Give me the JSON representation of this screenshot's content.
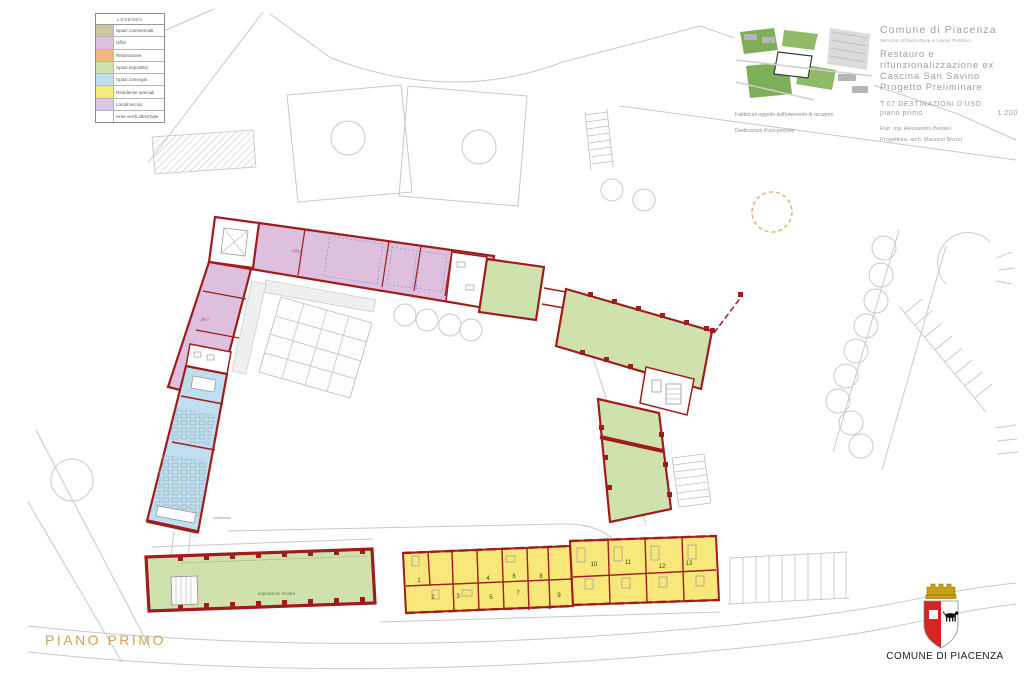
{
  "legend": {
    "title": "LEGENDA",
    "items": [
      {
        "label": "Spazi commerciali",
        "color": "#cdc6a0"
      },
      {
        "label": "Uffici",
        "color": "#dcc0dc"
      },
      {
        "label": "Ristorazione",
        "color": "#f3b579"
      },
      {
        "label": "Spazi espositivi",
        "color": "#cfe2ae"
      },
      {
        "label": "Spazi convegni",
        "color": "#bfdff0"
      },
      {
        "label": "Residenze speciali",
        "color": "#f8e97d"
      },
      {
        "label": "Locali tecnici",
        "color": "#d8c9e8"
      },
      {
        "label": "Aree verdi attrezzate",
        "color": "#ffffff"
      }
    ]
  },
  "title_block": {
    "municipality": "Comune di Piacenza",
    "department": "Servizio Infrastrutture e Lavori Pubblici",
    "project_lines": [
      "Restauro e",
      "rifunzionalizzazione ex",
      "Cascina San Savino",
      "Progetto Preliminare"
    ],
    "sheet_code": "T.07",
    "sheet_name": "DESTINAZIONI D'USO",
    "sheet_floor": "piano primo",
    "scale": "1:200",
    "rup": "Rup: ing. Alessandro Bertani",
    "designer": "Progettista: arch. Maurizio Bruzzi",
    "caption_1": "Fabbricati oggetto dell'intervento di recupero",
    "caption_2": "Destinazioni d'uso previste"
  },
  "plan": {
    "labels": {
      "office_1": "uffici",
      "office_2": "uffici",
      "conference": "conferenze",
      "exhibition_hall": "esposizioni mostre"
    },
    "room_numbers": [
      "1",
      "2",
      "3",
      "4",
      "5",
      "6",
      "7",
      "8",
      "9",
      "10",
      "11",
      "12",
      "13"
    ],
    "colors": {
      "walls": "#9e1c1c",
      "offices": "#dec0de",
      "exhibition": "#cfe2ae",
      "conference": "#bfdff0",
      "residences": "#f8e87a",
      "context": "#c8c8c8"
    }
  },
  "footer": {
    "floor_label": "PIANO PRIMO",
    "municipality": "COMUNE DI PIACENZA"
  }
}
